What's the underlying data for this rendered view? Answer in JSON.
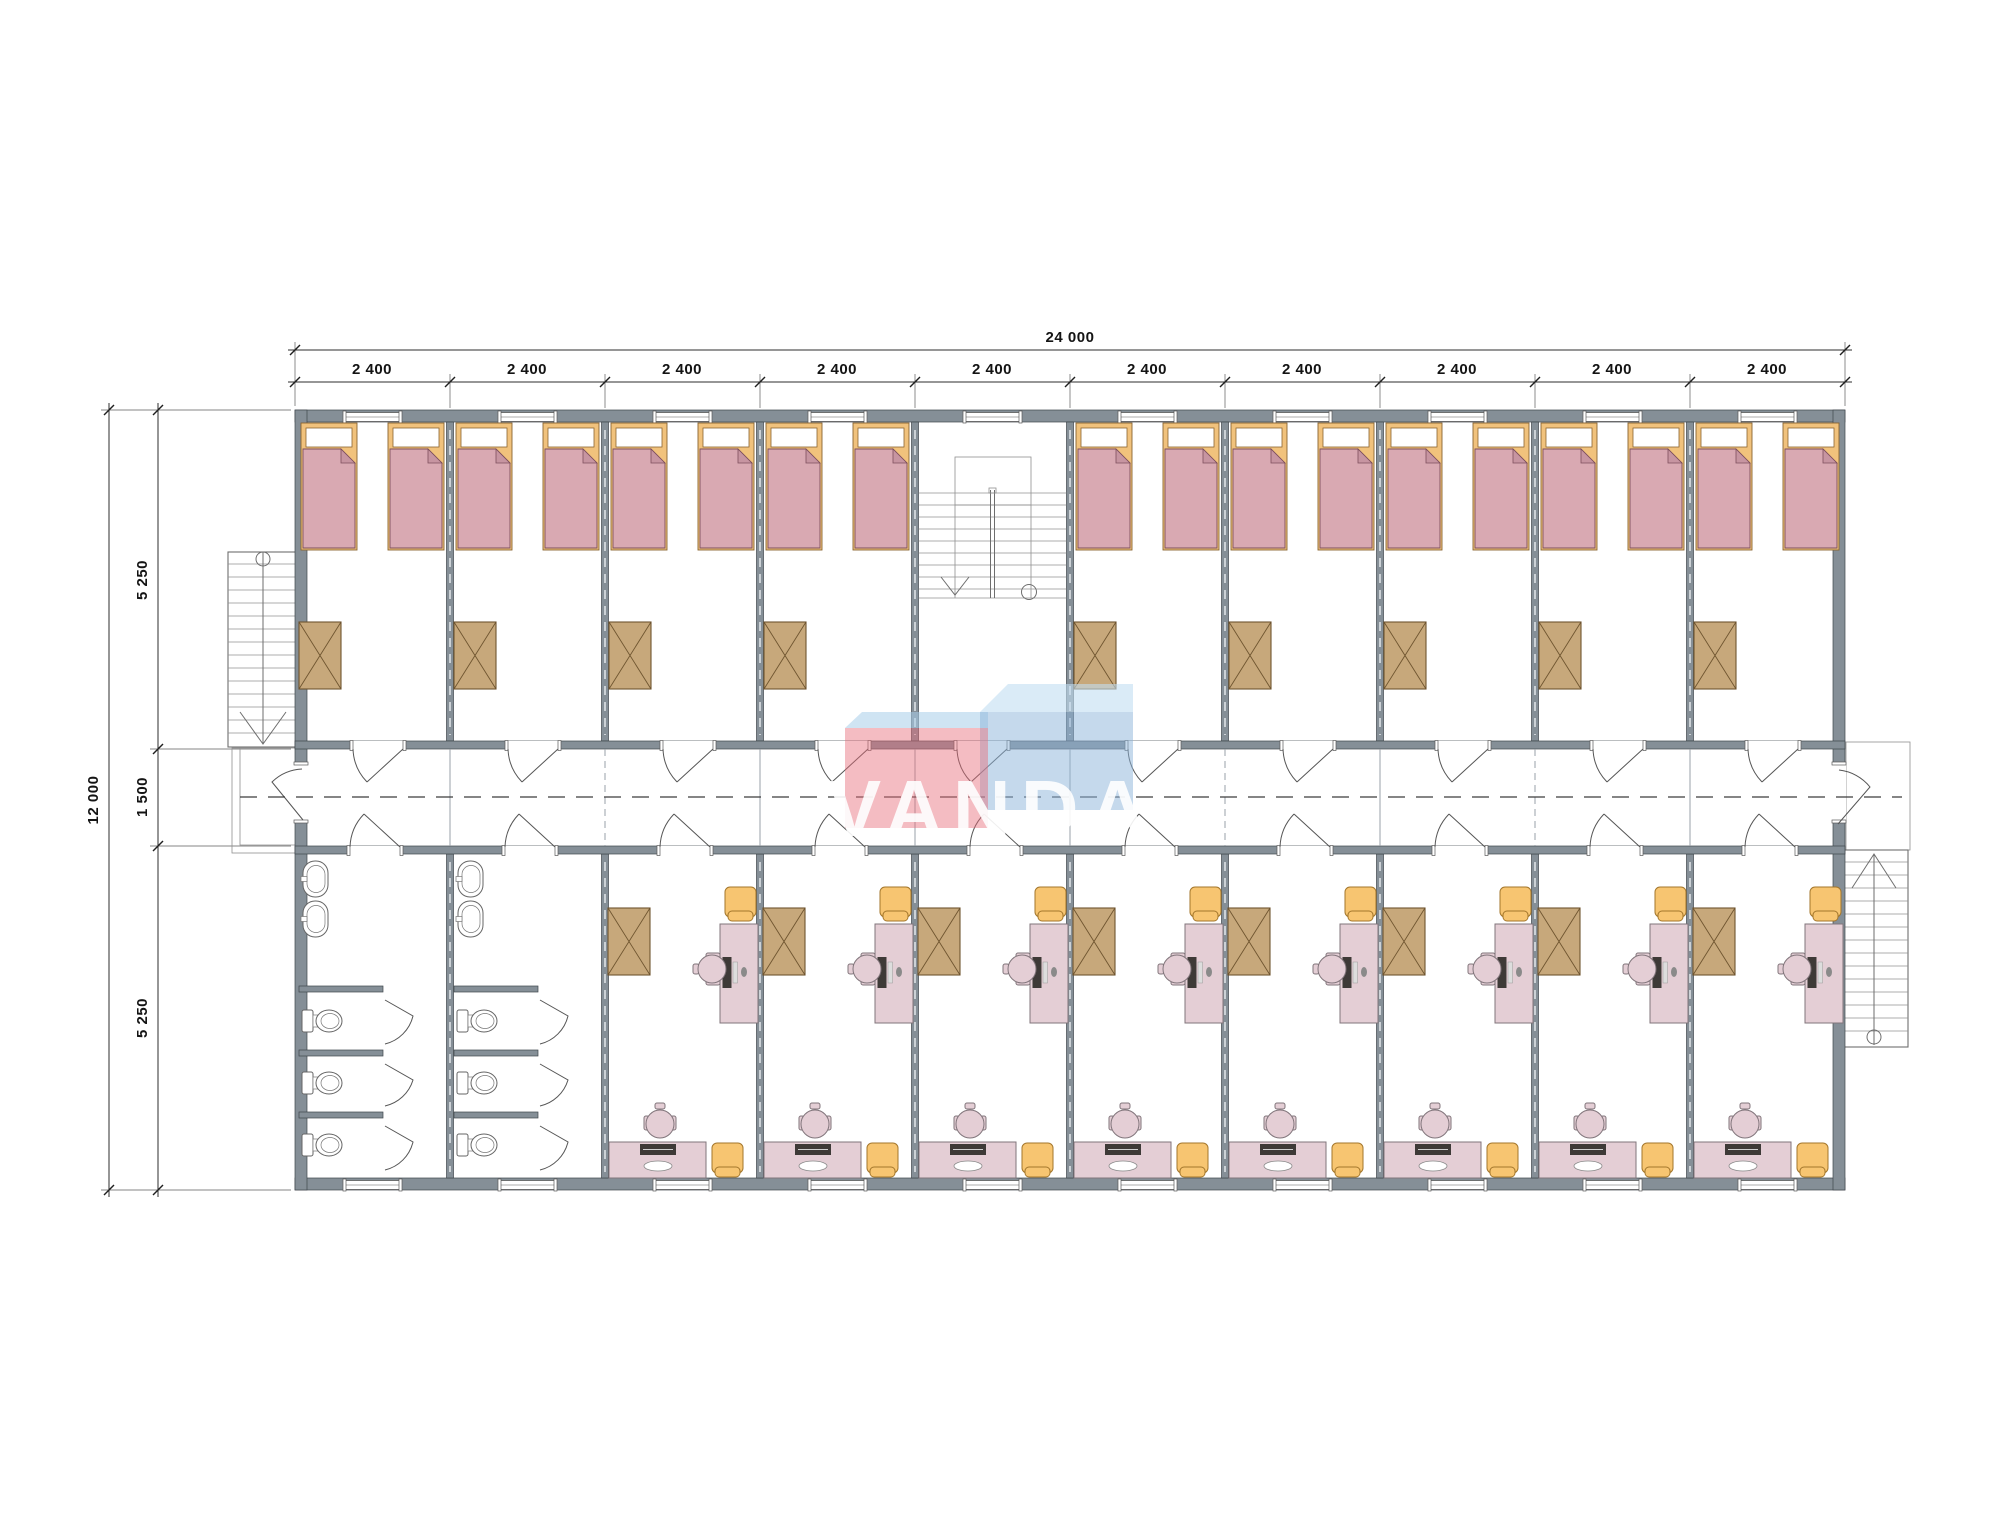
{
  "logo": {
    "text": "VANDA"
  },
  "dimensions": {
    "top_total": "24 000",
    "bay_labels": [
      "2 400",
      "2 400",
      "2 400",
      "2 400",
      "2 400",
      "2 400",
      "2 400",
      "2 400",
      "2 400",
      "2 400"
    ],
    "left_total": "12 000",
    "left_segments": [
      "5 250",
      "1 500",
      "5 250"
    ]
  },
  "colors": {
    "wall": "#858f97",
    "bed_frame": "#f1c27c",
    "bed_blanket": "#d9a9b2",
    "bed_fold": "#c795a1",
    "wardrobe": "#c7a87b",
    "furniture_pink": "#e4ced5",
    "stool": "#f7c571",
    "logo_red": "#e76b78",
    "logo_blue": "#8cb4da",
    "logo_top": "#a8cdea",
    "logo_top2": "#c2ddf1"
  }
}
